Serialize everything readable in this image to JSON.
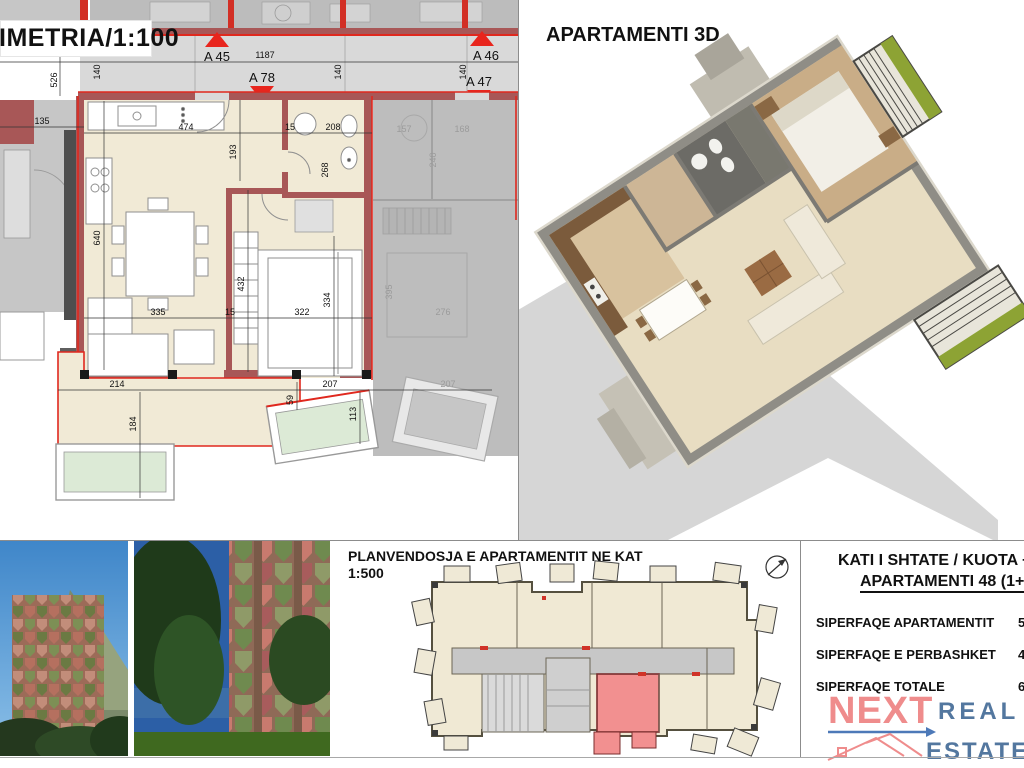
{
  "plan": {
    "title": "IMETRIA/1:100",
    "markers": {
      "a45": "A 45",
      "a78": "A 78",
      "a46": "A 46",
      "a47": "A 47"
    },
    "dims": {
      "d135": "135",
      "d526": "526",
      "d140a": "140",
      "d1187": "1187",
      "d140b": "140",
      "d140c": "140",
      "d474": "474",
      "d193": "193",
      "d15a": "15",
      "d208": "208",
      "d268": "268",
      "d640": "640",
      "d432": "432",
      "d335": "335",
      "d15b": "15",
      "d322": "322",
      "d334": "334",
      "d214": "214",
      "d184": "184",
      "d59": "59",
      "d207": "207",
      "d113": "113",
      "g157": "157",
      "g168": "168",
      "g240": "240",
      "g395": "395",
      "g276": "276",
      "g207b": "207"
    },
    "accent_red": "#e0281e",
    "wall_maroon": "#a85757",
    "floor_cream": "#f1ead6"
  },
  "three_d": {
    "title": "APARTAMENTI 3D"
  },
  "site": {
    "title": "PLANVENDOSJA E APARTAMENTIT NE KAT",
    "scale": "1:500",
    "highlight_pink": "#f29090"
  },
  "info": {
    "heading_line1": "KATI I SHTATE / KUOTA +",
    "heading_line2": "APARTAMENTI 48 (1+1",
    "rows": [
      {
        "label": "SIPERFAQE APARTAMENTIT",
        "value": "5"
      },
      {
        "label": "SIPERFAQE E PERBASHKET",
        "value": "4"
      },
      {
        "label": "SIPERFAQE TOTALE",
        "value": "6"
      }
    ]
  },
  "logo": {
    "word1": "NEXT",
    "word2": "REAL",
    "word3": "ESTATE",
    "coral": "#ef8c8c",
    "blue": "#53779f"
  }
}
